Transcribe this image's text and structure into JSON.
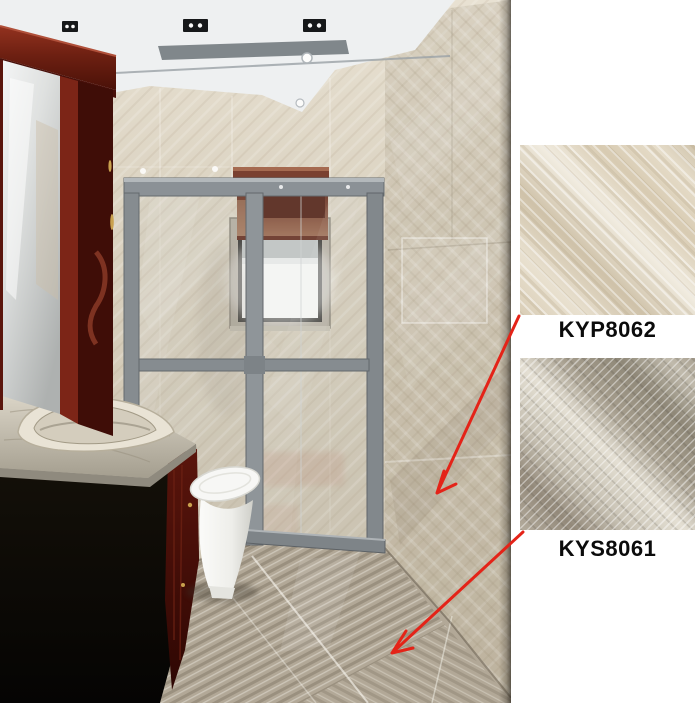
{
  "products": [
    {
      "code": "KYP8062",
      "tile_look": "beige marble with diagonal veining",
      "arrow_points_to": "bathroom wall"
    },
    {
      "code": "KYS8061",
      "tile_look": "grey stone with diagonal strata",
      "arrow_points_to": "bathroom floor"
    }
  ],
  "colors": {
    "page_background": "#ffffff",
    "arrow_red": "#e42318",
    "label_text": "#0b0b0b",
    "wall_tile_beige": "#d5ccba",
    "floor_tile_grey": "#aba290",
    "cabinet_mahogany": "#6e2012",
    "shower_frame_grey": "#8b9196",
    "ceiling_white": "#eef0f1",
    "toilet_white": "#f2f2ef"
  }
}
